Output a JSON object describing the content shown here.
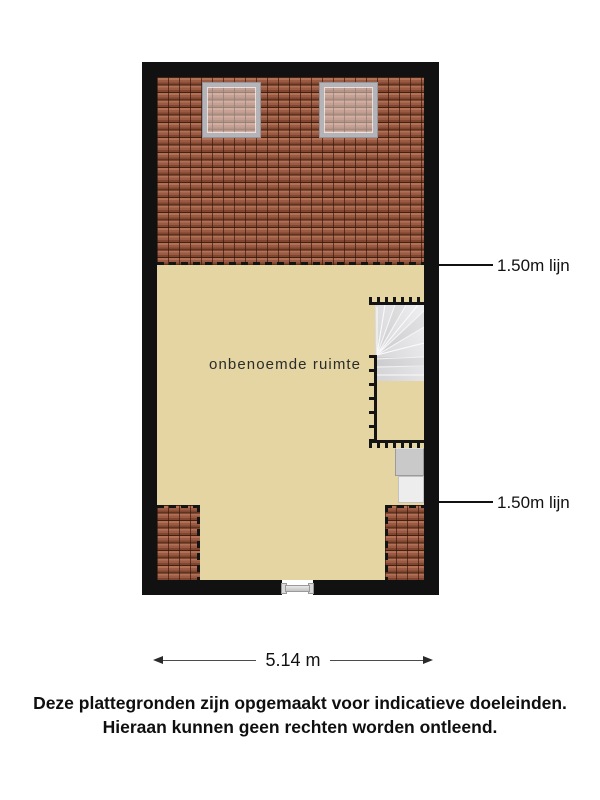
{
  "floorplan": {
    "room_label": "onbenoemde ruimte",
    "annotations": [
      {
        "label": "1.50m lijn"
      },
      {
        "label": "1.50m lijn"
      }
    ],
    "dimension": {
      "width_label": "5.14 m"
    }
  },
  "disclaimer": {
    "line1": "Deze plattegronden zijn opgemaakt voor indicatieve doeleinden.",
    "line2": "Hieraan kunnen geen rechten worden ontleend."
  },
  "colors": {
    "wall": "#111111",
    "floor": "#e4d5a3",
    "roof_base": "#9a5a44",
    "roof_light": "#b27056",
    "roof_dark": "#42210f",
    "roof_shadow": "#7f452e",
    "stair_fill": "#e4e4e6",
    "annotation": "#111111"
  }
}
